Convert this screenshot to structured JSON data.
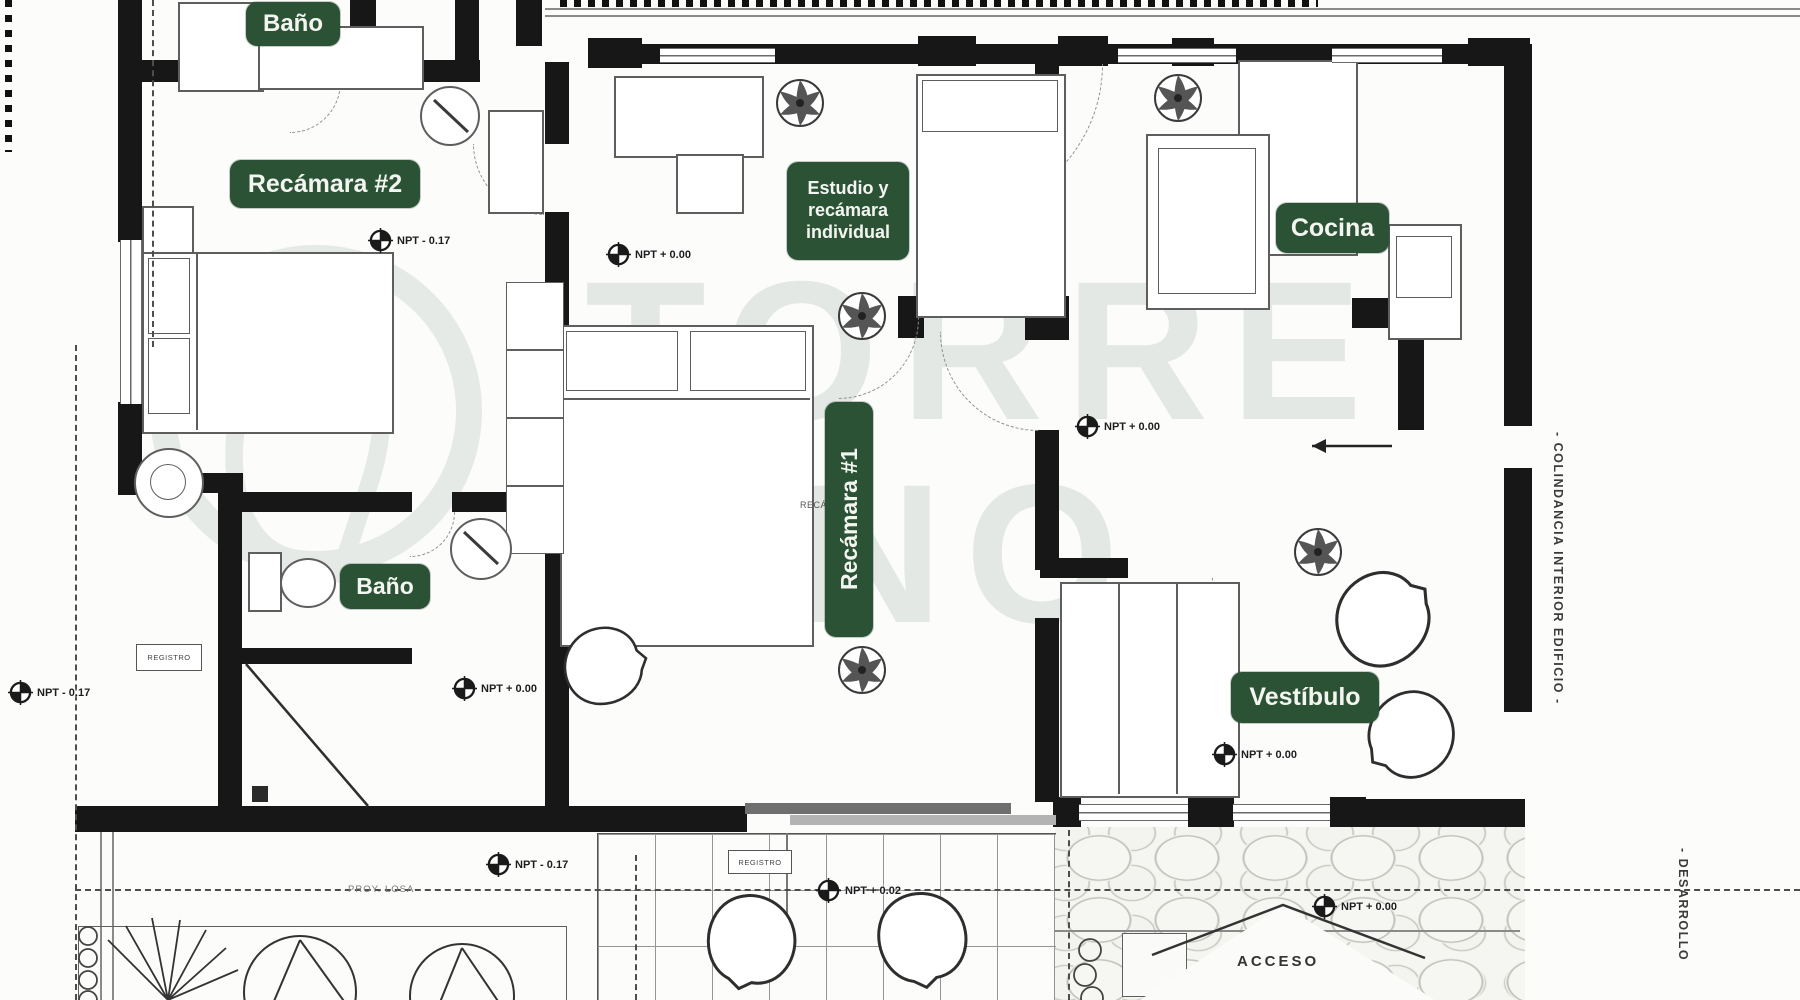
{
  "watermark": {
    "line1": "TORRE",
    "line2": "UNO"
  },
  "colors": {
    "label_bg": "#2c5236",
    "label_text": "#f3f5f0",
    "wall": "#171717"
  },
  "rooms": [
    {
      "id": "bano-1",
      "label": [
        "Baño"
      ],
      "x": 246,
      "y": 2,
      "w": 94,
      "h": 44,
      "font": 24,
      "vertical": false
    },
    {
      "id": "recamara-2",
      "label": [
        "Recámara #2"
      ],
      "x": 230,
      "y": 160,
      "w": 190,
      "h": 48,
      "font": 25,
      "vertical": false
    },
    {
      "id": "estudio",
      "label": [
        "Estudio y",
        "recámara",
        "individual"
      ],
      "x": 787,
      "y": 162,
      "w": 122,
      "h": 98,
      "font": 18,
      "vertical": false
    },
    {
      "id": "cocina",
      "label": [
        "Cocina"
      ],
      "x": 1276,
      "y": 203,
      "w": 113,
      "h": 50,
      "font": 25,
      "vertical": false
    },
    {
      "id": "recamara-1",
      "label": [
        "Recámara #1"
      ],
      "x": 825,
      "y": 402,
      "w": 48,
      "h": 235,
      "font": 23,
      "vertical": true
    },
    {
      "id": "bano-2",
      "label": [
        "Baño"
      ],
      "x": 340,
      "y": 564,
      "w": 90,
      "h": 45,
      "font": 23,
      "vertical": false
    },
    {
      "id": "vestibulo",
      "label": [
        "Vestíbulo"
      ],
      "x": 1231,
      "y": 672,
      "w": 148,
      "h": 51,
      "font": 25,
      "vertical": false
    }
  ],
  "npt_markers": [
    {
      "text": "NPT - 0.17",
      "x": 368,
      "y": 228
    },
    {
      "text": "NPT + 0.00",
      "x": 606,
      "y": 242
    },
    {
      "text": "NPT + 0.00",
      "x": 1075,
      "y": 414
    },
    {
      "text": "NPT - 0.17",
      "x": 8,
      "y": 680
    },
    {
      "text": "NPT + 0.00",
      "x": 452,
      "y": 676
    },
    {
      "text": "NPT + 0.00",
      "x": 1212,
      "y": 742
    },
    {
      "text": "NPT - 0.17",
      "x": 486,
      "y": 852
    },
    {
      "text": "NPT + 0.02",
      "x": 816,
      "y": 878
    },
    {
      "text": "NPT + 0.00",
      "x": 1312,
      "y": 894
    }
  ],
  "side_texts": {
    "right_upper": "- COLINDANCIA INTERIOR EDIFICIO -",
    "right_lower": "- DESARROLLO"
  },
  "small_texts": {
    "registro_1": "REGISTRO",
    "registro_2": "REGISTRO",
    "acceso": "ACCESO",
    "prov_losa": "PROY. LOSA",
    "recamara_1_plain": "RECÁMARA 1"
  }
}
